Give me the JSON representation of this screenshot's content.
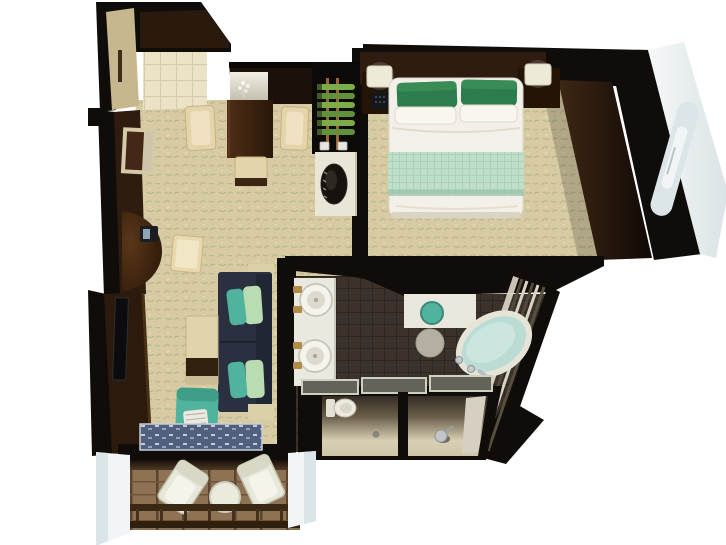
{
  "meta": {
    "title": "Suite floor plan — 3D top-down render",
    "type": "architectural-floor-plan",
    "view": "bird's-eye 3D cutaway"
  },
  "rooms": [
    {
      "name": "entry-hall",
      "floor": "cream tile"
    },
    {
      "name": "dining-area",
      "floor": "patterned carpet"
    },
    {
      "name": "living-room",
      "floor": "patterned carpet"
    },
    {
      "name": "bedroom",
      "floor": "patterned carpet"
    },
    {
      "name": "bathroom",
      "floor": "dark brown tile"
    },
    {
      "name": "water-closet",
      "floor": "beige"
    },
    {
      "name": "shower-room",
      "floor": "beige"
    },
    {
      "name": "balcony",
      "floor": "wood deck planks"
    }
  ],
  "furniture": {
    "entry": [
      "open entry door",
      "tiled threshold"
    ],
    "dining": [
      "dark wood dining table",
      "two cream armchairs",
      "cream bench",
      "lighted display niche with white orchid",
      "wine rack with green bottles",
      "bar counter with dark decorative bowl"
    ],
    "living": [
      "half-round wall desk",
      "telephone",
      "cream stool",
      "wall mirror",
      "wall-mounted TV",
      "navy sofa",
      "teal cushion",
      "mint cushion",
      "cream side table with wood band",
      "teal armchair with striped pillow",
      "blue patterned area rug"
    ],
    "bedroom": [
      "double bed with white duvet",
      "two green pillows",
      "two white pillows",
      "mint patterned bed runner",
      "two nightstands",
      "two bedside lamps",
      "telephone",
      "dark wood wardrobe"
    ],
    "bathroom": [
      "double vanity with two round vessel sinks",
      "gold faucets",
      "teal vanity stool",
      "round gray rug",
      "oval soaking tub",
      "tiered tub platform",
      "glass partitions",
      "toilet",
      "floor drain",
      "shower fixture"
    ],
    "balcony": [
      "two white lounge chairs",
      "round white table",
      "deck railing",
      "white side bulkheads"
    ]
  },
  "palette": {
    "wall_black": "#0f0c09",
    "wood_dark": "#2e1c10",
    "wood_table": "#3c2312",
    "carpet_base": "#d8cba3",
    "tile_cream": "#ebe3c6",
    "sofa_navy": "#2a3040",
    "teal": "#4fb39e",
    "mint": "#b9dcb2",
    "bed_white": "#f2f0e8",
    "pillow_green": "#2d7c4e",
    "runner_mint": "#c0dfca",
    "tub_aqua": "#badcd4",
    "bath_floor": "#3a322b",
    "vanity_white": "#ebe9df",
    "deck_wood": "#8e7254",
    "hull_white": "#f1f5f5",
    "gold": "#b08c48",
    "cream_chair": "#e3d4a9",
    "glass_gray": "#63635a"
  }
}
